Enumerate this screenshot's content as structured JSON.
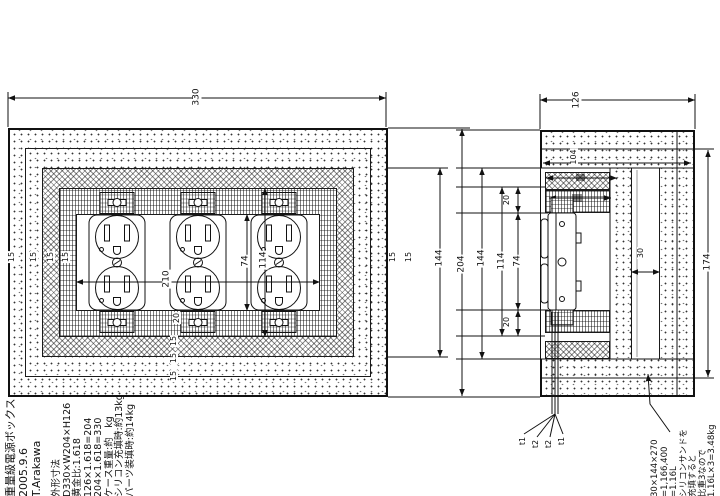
{
  "drawing": {
    "title_block": {
      "title": "重量級電源ボックス",
      "date": "2005.9.6",
      "author": "T.Arakawa"
    },
    "spec_block": {
      "lines": [
        "外形寸法",
        "D330×W204×H126",
        "黄金比:1.618",
        "126×1.618=204",
        "204×1.618=330",
        "ケース重量:約　kg",
        "シリコン充填時:約13kg",
        "パーツ装填時:約14kg"
      ]
    },
    "volume_note": {
      "lines": [
        "30×144×270",
        "=1,166,400",
        "=1.16L",
        "シリコンサンドを",
        "充填すると",
        "比重3なので",
        "1.16L×3=3.48kg"
      ]
    },
    "front_view": {
      "dims": {
        "width": "330",
        "outlet_span": "210",
        "outlet_h": "74",
        "opening_h": "114",
        "inner_h": "144",
        "height": "204",
        "frame_b": "20",
        "l1": "15",
        "l2": "15",
        "l3": "15",
        "l4": "15",
        "b1": "15",
        "b2": "15",
        "b3": "15",
        "r1": "15",
        "r2": "15"
      }
    },
    "side_view": {
      "dims": {
        "depth": "126",
        "inner_depth": "104",
        "case_h": "174",
        "cavity_h": "144",
        "opening_h": "114",
        "outlet_h": "74",
        "t_top": "20",
        "t_bottom": "20",
        "sand": "30"
      }
    },
    "wires": {
      "labels": [
        "t1",
        "t2",
        "t2",
        "t1"
      ]
    }
  }
}
